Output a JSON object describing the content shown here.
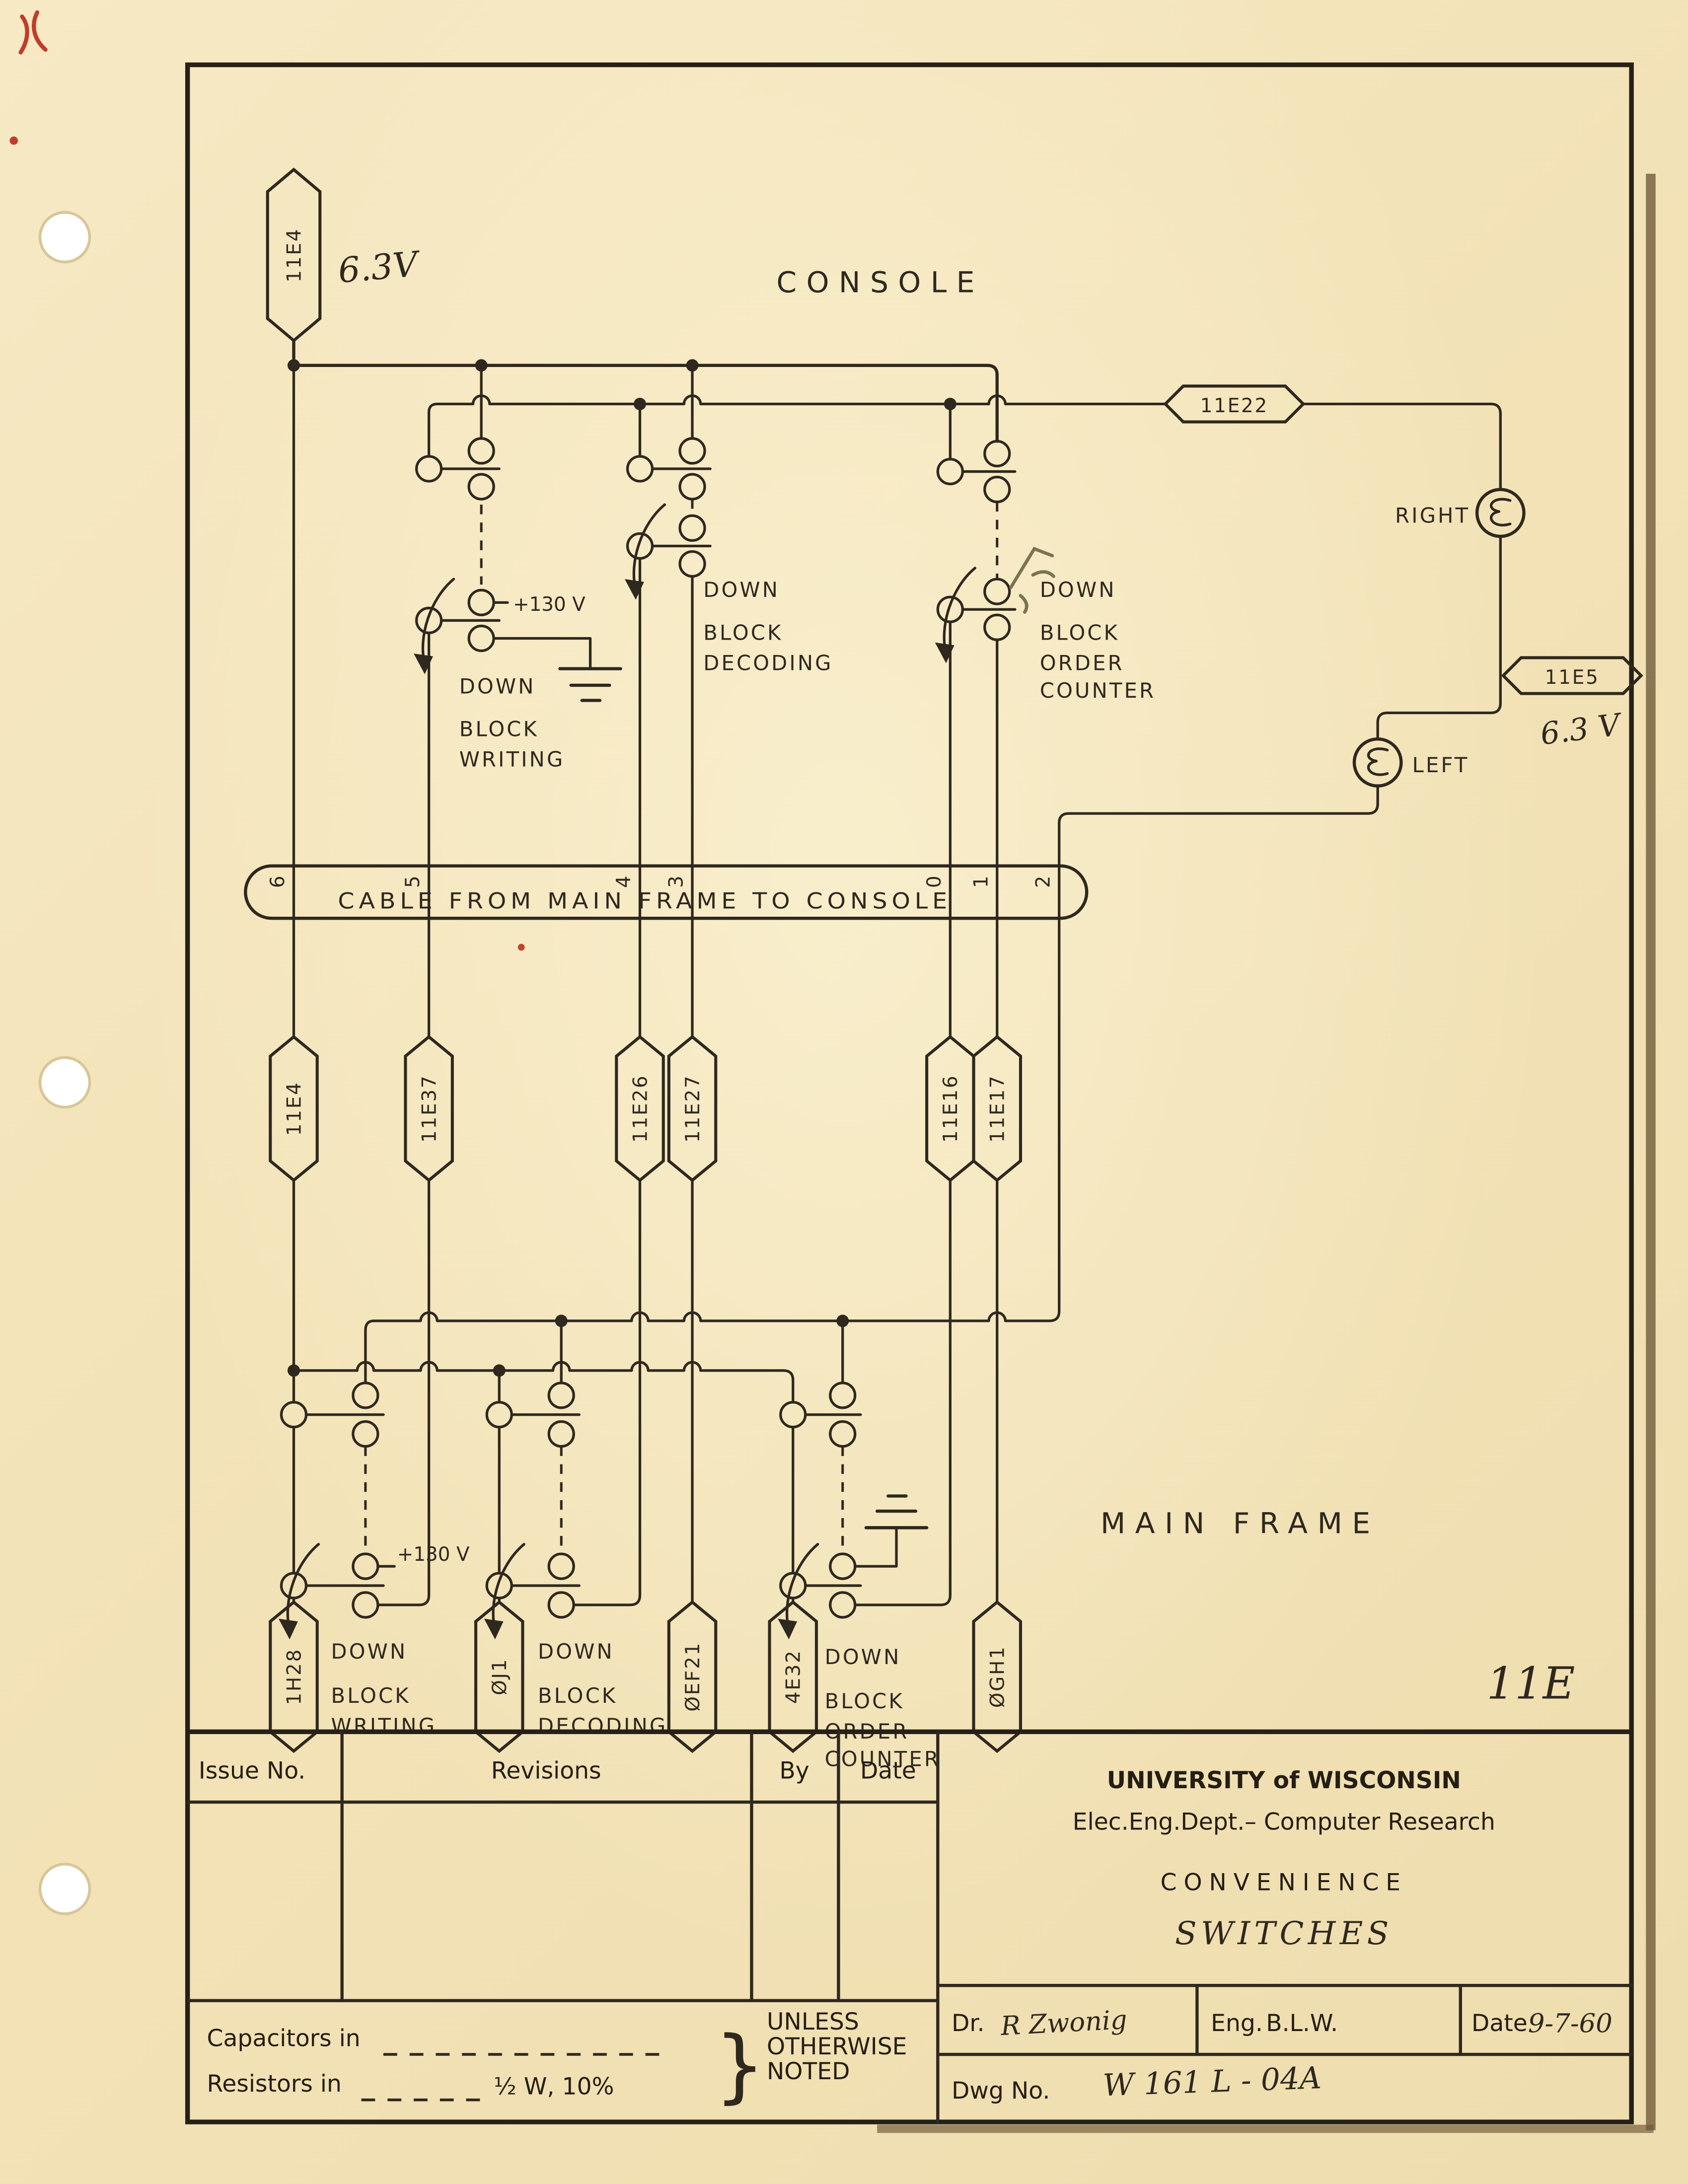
{
  "document": {
    "page_number": "11E"
  },
  "sections": {
    "console": "CONSOLE",
    "main_frame": "MAIN FRAME"
  },
  "tags": {
    "top": "11E4",
    "e22": "11E22",
    "e5": "11E5",
    "row": [
      "11E4",
      "11E37",
      "11E26",
      "11E27",
      "11E16",
      "11E17"
    ],
    "bottom": [
      "1H28",
      "ØJ1",
      "ØEF21",
      "4E32",
      "ØGH1"
    ]
  },
  "voltages": {
    "v63_top": "6.3V",
    "v63_right": "6.3 V",
    "v130": "+130 V"
  },
  "lamps": {
    "right": "RIGHT",
    "left": "LEFT"
  },
  "switch_labels": {
    "down": "DOWN",
    "block": "BLOCK",
    "writing": "WRITING",
    "decoding": "DECODING",
    "order": "ORDER",
    "counter": "COUNTER"
  },
  "cable": {
    "label": "CABLE FROM MAIN FRAME TO CONSOLE",
    "conductors": [
      "6",
      "5",
      "4",
      "3",
      "0",
      "1",
      "2"
    ]
  },
  "title_block": {
    "issue_no": "Issue No.",
    "revisions": "Revisions",
    "by": "By",
    "date_col": "Date",
    "org": "UNIVERSITY of WISCONSIN",
    "dept": "Elec.Eng.Dept.– Computer Research",
    "title_line1": "CONVENIENCE",
    "title_line2": "SWITCHES",
    "dr_label": "Dr.",
    "dr_value": "R Zwonig",
    "eng_label": "Eng.",
    "eng_value": "B.L.W.",
    "date_label": "Date",
    "date_value": "9-7-60",
    "dwg_label": "Dwg No.",
    "dwg_value": "W 161 L - 04A",
    "capacitors": "Capacitors in",
    "resistors": "Resistors in",
    "resistor_spec": "½ W, 10%",
    "unless": [
      "UNLESS",
      "OTHERWISE",
      "NOTED"
    ]
  }
}
